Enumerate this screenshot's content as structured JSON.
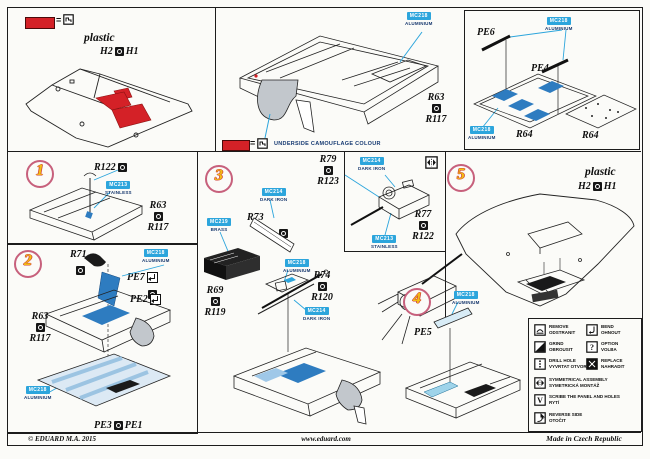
{
  "footer": {
    "copyright": "© EDUARD  M.A. 2015",
    "website": "www.eduard.com",
    "made_in": "Made in Czech Republic"
  },
  "top_left": {
    "eq": "=",
    "plastic": "plastic",
    "h2": "H2",
    "h1": "H1"
  },
  "top_mid": {
    "paint": {
      "code": "MC218",
      "name": "ALUMINIUM"
    },
    "r63": "R63",
    "r117": "R117",
    "eq": "=",
    "note": "UNDERSIDE CAMOUFLAGE COLOUR"
  },
  "top_right": {
    "pe6": "PE6",
    "pe4": "PE4",
    "paint_top": {
      "code": "MC218",
      "name": "ALUMINIUM"
    },
    "paint_left": {
      "code": "MC218",
      "name": "ALUMINIUM"
    },
    "r64_left": "R64",
    "r64_right": "R64"
  },
  "step1": {
    "num": "1",
    "r122": "R122",
    "paint": {
      "code": "MC213",
      "name": "STAINLESS"
    },
    "r63": "R63",
    "r117": "R117"
  },
  "step2": {
    "num": "2",
    "r71": "R71",
    "paint_top": {
      "code": "MC218",
      "name": "ALUMINIUM"
    },
    "pe7": "PE7",
    "pe2": "PE2",
    "r63": "R63",
    "r117": "R117",
    "paint_left": {
      "code": "MC218",
      "name": "ALUMINIUM"
    },
    "pe3": "PE3",
    "pe1": "PE1"
  },
  "step3": {
    "num": "3",
    "paint_dark_iron": {
      "code": "MC214",
      "name": "DARK IRON"
    },
    "paint_brass": {
      "code": "MC219",
      "name": "BRASS"
    },
    "r73": "R73",
    "paint_alu": {
      "code": "MC218",
      "name": "ALUMINIUM"
    },
    "r74": "R74",
    "r120": "R120",
    "r69": "R69",
    "r119": "R119",
    "paint_dark_iron2": {
      "code": "MC214",
      "name": "DARK IRON"
    }
  },
  "gun_box": {
    "r79": "R79",
    "r123": "R123",
    "paint_top": {
      "code": "MC214",
      "name": "DARK IRON"
    },
    "r77": "R77",
    "r122": "R122",
    "paint_bottom": {
      "code": "MC213",
      "name": "STAINLESS"
    }
  },
  "step4": {
    "num": "4",
    "paint": {
      "code": "MC218",
      "name": "ALUMINIUM"
    },
    "pe5": "PE5"
  },
  "step5": {
    "num": "5",
    "plastic": "plastic",
    "h2": "H2",
    "h1": "H1"
  },
  "legend": {
    "items": [
      {
        "icon": "remove-icon",
        "en": "REMOVE",
        "cz": "ODSTRANIT"
      },
      {
        "icon": "bend-icon",
        "en": "BEND",
        "cz": "OHNOUT"
      },
      {
        "icon": "grind-icon",
        "en": "GRIND",
        "cz": "OBROUSIT"
      },
      {
        "icon": "option-icon",
        "glyph": "?",
        "en": "OPTION",
        "cz": "VOLBA"
      },
      {
        "icon": "drill-hole-icon",
        "en": "DRILL HOLE",
        "cz": "VYVRTAT OTVOR"
      },
      {
        "icon": "replace-icon",
        "en": "REPLACE",
        "cz": "NAHRADIT"
      },
      {
        "icon": "symmetrical-assembly-icon",
        "en": "SYMMETRICAL ASSEMBLY",
        "cz": "SYMETRICKÁ MONTÁŽ"
      },
      {
        "icon": "scribe-icon",
        "glyph": "V",
        "en": "SCRIBE THE PANEL AND HOLES",
        "cz": "RYTÍ"
      },
      {
        "icon": "reverse-side-icon",
        "en": "REVERSE SIDE",
        "cz": "OTOČIT"
      }
    ]
  },
  "colors": {
    "red": "#d42127",
    "azure": "#2ca5dc",
    "pe_blue": "#2e7cc0",
    "pe_light": "#dce9f4",
    "grey": "#c2c7cc",
    "step_yellow": "#f2bd13",
    "step_ring": "#c7607c"
  }
}
